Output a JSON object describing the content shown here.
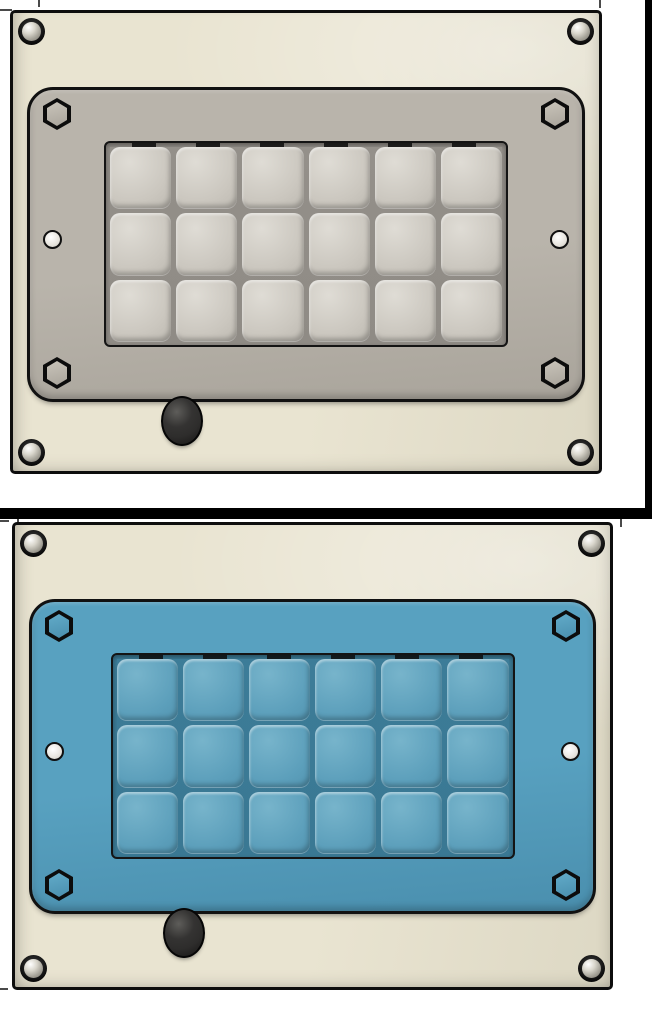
{
  "canvas": {
    "width": 652,
    "height": 1024,
    "background": "#ffffff"
  },
  "frame": {
    "right_edge_bar_color": "#000000",
    "divider_bar_color": "#000000",
    "crop_tick_color": "#4a4a4a",
    "tick_count": 7
  },
  "panels": [
    {
      "name": "keypad-enclosure-gray",
      "variant": "gray-faceplate",
      "corner_screws": 4,
      "hex_bolts": 4,
      "side_holes": 2,
      "knobs": 1,
      "keypad": {
        "rows": 3,
        "cols": 6,
        "button_count": 18
      },
      "colors": {
        "body": "#e9e4d1",
        "body_dk": "#ddd8c4",
        "faceplate": "#b9b4ab",
        "faceplate_dk": "#a9a49b",
        "bolt": "#c6c1b7",
        "button": "#cac6be",
        "button_hi": "#dfdcd5",
        "button_dk": "#b2aea6",
        "groove": "#94908a",
        "keypad_bg": "#8f8b85",
        "hole": "#e6e3dc",
        "knob": "#2e2d2c",
        "screw_ball": "#d9d6cc"
      }
    },
    {
      "name": "keypad-enclosure-blue",
      "variant": "blue-faceplate",
      "corner_screws": 4,
      "hex_bolts": 4,
      "side_holes": 2,
      "knobs": 1,
      "keypad": {
        "rows": 3,
        "cols": 6,
        "button_count": 18
      },
      "colors": {
        "body": "#e9e4d1",
        "body_dk": "#ddd8c4",
        "faceplate": "#58a1c0",
        "faceplate_dk": "#4a8fae",
        "bolt": "#5fa8c6",
        "button": "#5c9fbb",
        "button_hi": "#77b4cb",
        "button_dk": "#4b8ba7",
        "groove": "#3c7c98",
        "keypad_bg": "#3a7893",
        "hole": "#e8e5df",
        "knob": "#2e2d2c",
        "screw_ball": "#d9d6cc"
      }
    }
  ]
}
